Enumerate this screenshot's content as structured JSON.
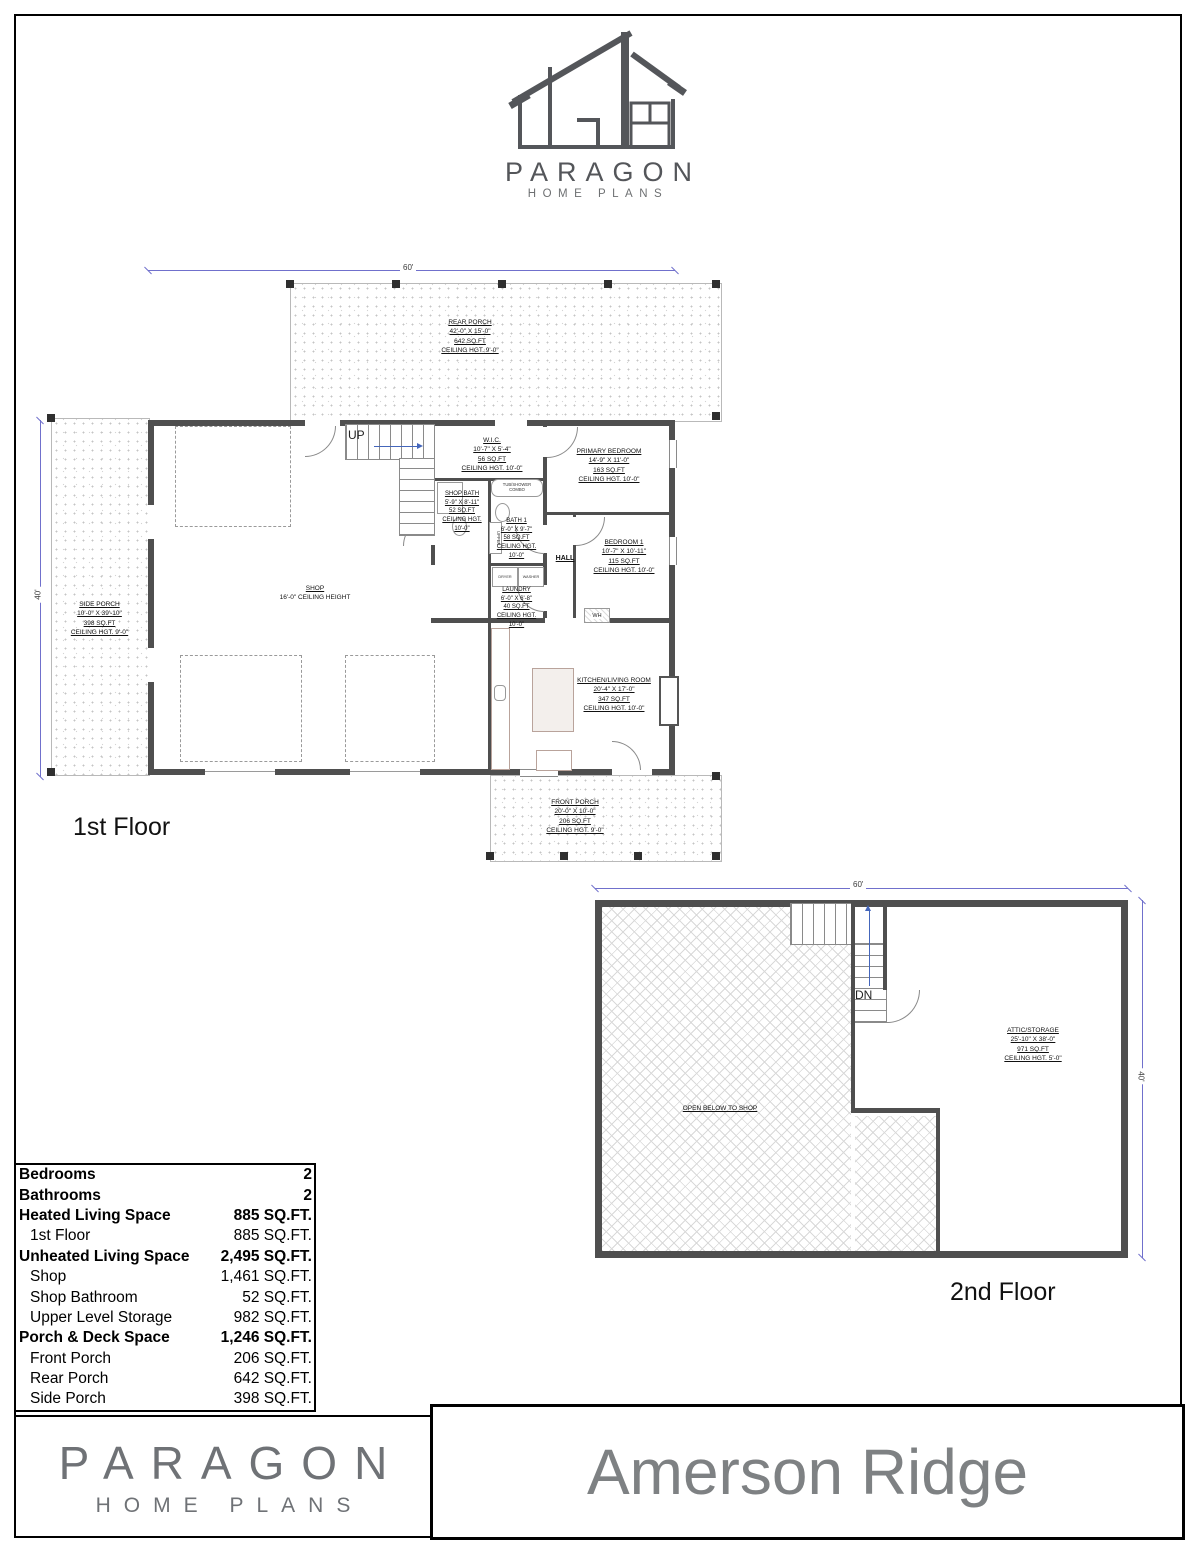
{
  "logo": {
    "brand": "PARAGON",
    "sub": "HOME PLANS"
  },
  "colors": {
    "dimension_blue": "#7070cc",
    "wall_gray": "#4f4f4f",
    "brand_gray": "#6f7276"
  },
  "floor1": {
    "title": "1st Floor",
    "dim_top": "60'",
    "dim_left": "40'",
    "rooms": {
      "rear_porch": "REAR PORCH\n42'-0\" X 15'-0\"\n642 SQ.FT\nCEILING HGT. 9'-0\"",
      "side_porch": "SIDE PORCH\n10'-0\" X 39'-10\"\n398 SQ.FT\nCEILING HGT. 9'-0\"",
      "front_porch": "FRONT PORCH\n20'-0\" X 10'-0\"\n206 SQ.FT\nCEILING HGT. 9'-0\"",
      "shop_name": "SHOP",
      "shop_sub": "16'-0\" CEILING HEIGHT",
      "wic": "W.I.C.\n10'-7\" X 5'-4\"\n56 SQ.FT\nCEILING HGT. 10'-0\"",
      "shop_bath": "SHOP BATH\n5'-9\" X 8'-11\"\n52 SQ.FT\nCEILING HGT.\n10'-0\"",
      "bath1": "BATH 1\n6'-0\" X 9'-7\"\n58 SQ.FT\nCEILING HGT.\n10'-0\"",
      "laundry": "LAUNDRY\n6'-0\" X 6'-8\"\n40 SQ.FT\nCEILING HGT.\n10'-0\"",
      "primary_bedroom": "PRIMARY BEDROOM\n14'-9\" X 11'-0\"\n163 SQ.FT\nCEILING HGT. 10'-0\"",
      "bedroom1": "BEDROOM 1\n10'-7\" X 10'-11\"\n115 SQ.FT\nCEILING HGT. 10'-0\"",
      "kitchen_living": "KITCHEN/LIVING ROOM\n20'-4\" X 17'-0\"\n347 SQ.FT\nCEILING HGT. 10'-0\"",
      "hall": "HALL",
      "up": "UP",
      "dryer": "DRYER",
      "washer": "WASHER",
      "tub": "TUB/SHOWER\nCOMBO",
      "upper": "UPPER",
      "wh": "WH"
    }
  },
  "floor2": {
    "title": "2nd Floor",
    "dim_top": "60'",
    "dim_right": "40'",
    "rooms": {
      "attic": "ATTIC/STORAGE\n25'-10\" X 38'-0\"\n971 SQ.FT\nCEILING HGT. 5'-0\"",
      "open_below": "OPEN BELOW TO SHOP",
      "dn": "DN"
    }
  },
  "stats": {
    "rows": [
      {
        "label": "Bedrooms",
        "value": "2"
      },
      {
        "label": "Bathrooms",
        "value": "2"
      },
      {
        "label": "Heated Living Space",
        "value": "885 SQ.FT."
      },
      {
        "label": "1st Floor",
        "value": "885 SQ.FT."
      },
      {
        "label": "Unheated Living Space",
        "value": "2,495 SQ.FT."
      },
      {
        "label": "Shop",
        "value": "1,461 SQ.FT."
      },
      {
        "label": "Shop Bathroom",
        "value": "52 SQ.FT."
      },
      {
        "label": "Upper Level Storage",
        "value": "982 SQ.FT."
      },
      {
        "label": "Porch & Deck Space",
        "value": "1,246 SQ.FT."
      },
      {
        "label": "Front Porch",
        "value": "206 SQ.FT."
      },
      {
        "label": "Rear Porch",
        "value": "642 SQ.FT."
      },
      {
        "label": "Side Porch",
        "value": "398 SQ.FT."
      }
    ]
  },
  "footer": {
    "brand": "PARAGON",
    "sub": "HOME PLANS",
    "plan_name": "Amerson Ridge"
  }
}
